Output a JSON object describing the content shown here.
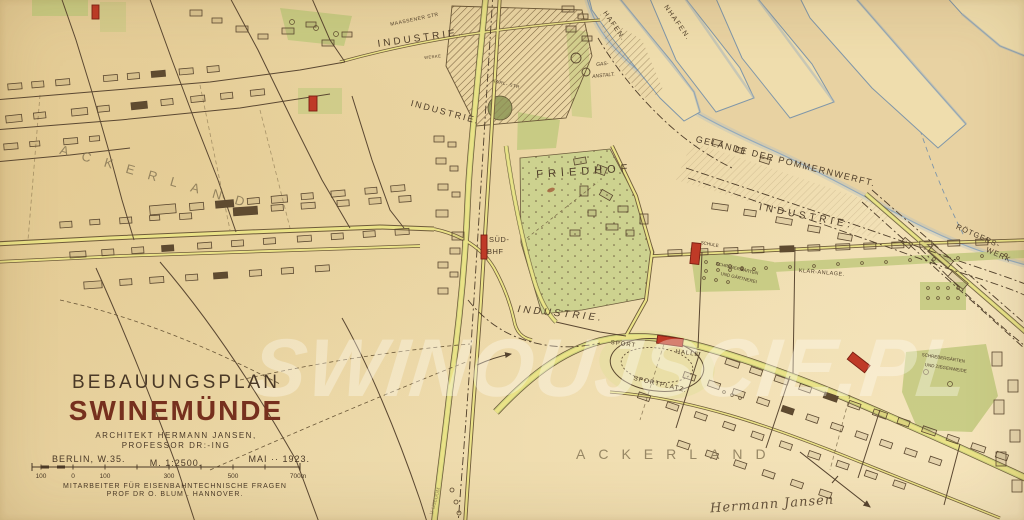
{
  "title_block": {
    "plan_type": "BEBAUUNGSPLAN",
    "city": "SWINEMÜNDE",
    "architect_line1": "ARCHITEKT HERMANN JANSEN,",
    "architect_line2": "PROFESSOR DR:-ING",
    "location": "BERLIN, W.35.",
    "scale": "M. 1:2500.",
    "date": "MAI ·· 1923.",
    "scale_bar": {
      "ticks": [
        {
          "t": "100",
          "x": 13
        },
        {
          "t": "0",
          "x": 45
        },
        {
          "t": "100",
          "x": 77
        },
        {
          "t": "300",
          "x": 141
        },
        {
          "t": "500",
          "x": 205
        },
        {
          "t": "700m",
          "x": 270
        }
      ]
    },
    "collaborator_line1": "MITARBEITER FÜR EISENBAHNTECHNISCHE FRAGEN",
    "collaborator_line2": "PROF DR O. BLUM . HANNOVER."
  },
  "signature": {
    "text": "Hermann Jansen"
  },
  "watermark": {
    "text": "SWINOUJSCIE.PL"
  },
  "map": {
    "labels": [
      {
        "n": "region-label-ackerland-west",
        "t": "ACKERLAND",
        "x": 62,
        "y": 143,
        "r": 16,
        "s": 13,
        "sp": 14,
        "c": "faint"
      },
      {
        "n": "street-label-maassener-str",
        "t": "MAASSENER STR",
        "x": 390,
        "y": 23,
        "r": -12,
        "s": 5,
        "sp": 0.5
      },
      {
        "n": "area-label-industrie-north",
        "t": "INDUSTRIE.",
        "x": 377,
        "y": 40,
        "r": -8,
        "s": 10,
        "sp": 3
      },
      {
        "n": "label-werke",
        "t": "WERKE",
        "x": 424,
        "y": 56,
        "r": -6,
        "s": 4,
        "sp": 0.5
      },
      {
        "n": "area-label-industrie-upper",
        "t": "INDUSTRIE.",
        "x": 412,
        "y": 99,
        "r": 15,
        "s": 9,
        "sp": 2
      },
      {
        "n": "street-label-karl-str",
        "t": "KARL- STR",
        "x": 493,
        "y": 79,
        "r": 14,
        "s": 4.5,
        "sp": 0.5
      },
      {
        "n": "harbor-label-hafen",
        "t": "HAFEN.",
        "x": 607,
        "y": 10,
        "r": 55,
        "s": 7,
        "sp": 1.5
      },
      {
        "n": "harbor-label-nhafen",
        "t": "NHAFEN.",
        "x": 668,
        "y": 4,
        "r": 55,
        "s": 7,
        "sp": 1.5
      },
      {
        "n": "label-gas",
        "t": "GAS-",
        "x": 596,
        "y": 63,
        "r": -6,
        "s": 5,
        "i": true
      },
      {
        "n": "label-anstalt",
        "t": "ANSTALT.",
        "x": 592,
        "y": 75,
        "r": -6,
        "s": 5,
        "i": true
      },
      {
        "n": "area-label-pommernwerft",
        "t": "GELÄNDE DER POMMERNWERFT.",
        "x": 697,
        "y": 135,
        "r": 14,
        "s": 9,
        "sp": 1.5
      },
      {
        "n": "area-label-friedhof",
        "t": "FRIEDHOF",
        "x": 536,
        "y": 170,
        "r": -4,
        "s": 11,
        "sp": 5
      },
      {
        "n": "area-label-industrie-east",
        "t": "INDUSTRIE.",
        "x": 760,
        "y": 203,
        "r": 11,
        "s": 10,
        "sp": 4
      },
      {
        "n": "label-roetgers",
        "t": "RÖTGERS-",
        "x": 958,
        "y": 223,
        "r": 24,
        "s": 7.5,
        "sp": 1
      },
      {
        "n": "label-werk",
        "t": "WERK",
        "x": 988,
        "y": 246,
        "r": 24,
        "s": 7.5,
        "sp": 1
      },
      {
        "n": "station-label-sued",
        "t": "SÜD-",
        "x": 489,
        "y": 236,
        "r": 0,
        "s": 7.5,
        "sp": 0.5
      },
      {
        "n": "station-label-bhf",
        "t": "BHF",
        "x": 487,
        "y": 248,
        "r": 0,
        "s": 7.5,
        "sp": 0.5
      },
      {
        "n": "area-label-industrie-center",
        "t": "INDUSTRIE.",
        "x": 518,
        "y": 305,
        "r": 6,
        "s": 10,
        "sp": 3,
        "i": true
      },
      {
        "n": "label-schule",
        "t": "SCHULE",
        "x": 701,
        "y": 241,
        "r": 10,
        "s": 4.5
      },
      {
        "n": "label-schrebergaerten-1",
        "t": "SCHREBERGÄRTEN",
        "x": 716,
        "y": 262,
        "r": 13,
        "s": 4.5
      },
      {
        "n": "label-und-gaertnerei",
        "t": "UND GÄRTNEREI",
        "x": 721,
        "y": 272,
        "r": 13,
        "s": 4.5
      },
      {
        "n": "label-klaeranlage",
        "t": "KLÄR-ANLAGE.",
        "x": 799,
        "y": 269,
        "r": 5,
        "s": 5.5,
        "sp": 0.5
      },
      {
        "n": "label-sport",
        "t": "SPORT",
        "x": 611,
        "y": 340,
        "r": 7,
        "s": 6,
        "sp": 1
      },
      {
        "n": "label-halle",
        "t": "HALLE",
        "x": 676,
        "y": 349,
        "r": 8,
        "s": 6,
        "sp": 1
      },
      {
        "n": "label-sportplatz",
        "t": "SPORTPLATZ.",
        "x": 634,
        "y": 376,
        "r": 13,
        "s": 6.5,
        "sp": 1
      },
      {
        "n": "label-schrebergaerten-2",
        "t": "SCHREBERGÄRTEN",
        "x": 922,
        "y": 353,
        "r": 9,
        "s": 4.5
      },
      {
        "n": "label-und-ziegenweide",
        "t": "UND ZIEGENWEIDE",
        "x": 925,
        "y": 363,
        "r": 9,
        "s": 4.5
      },
      {
        "n": "region-label-ackerland-south",
        "t": "ACKERLAND",
        "x": 576,
        "y": 447,
        "r": 0,
        "s": 14,
        "sp": 13,
        "c": "faint"
      },
      {
        "n": "road-label-usedom",
        "t": "V. USEDOM",
        "x": 430,
        "y": 514,
        "r": -75,
        "s": 5,
        "c": "faint"
      }
    ]
  },
  "colors": {
    "paper": "#ecd8a6",
    "ink": "#54422e",
    "label_faint": "#9c8c6b",
    "road_yellow": "#eae287",
    "verge_green": "#c9cf7c",
    "area_green": "#c9d08c",
    "building_red": "#bf3a27",
    "water_blue": "#8ba3b6",
    "title_ink": "#4a3927",
    "title_red": "#76301e",
    "watermark_white": "rgba(255,252,244,0.36)"
  }
}
